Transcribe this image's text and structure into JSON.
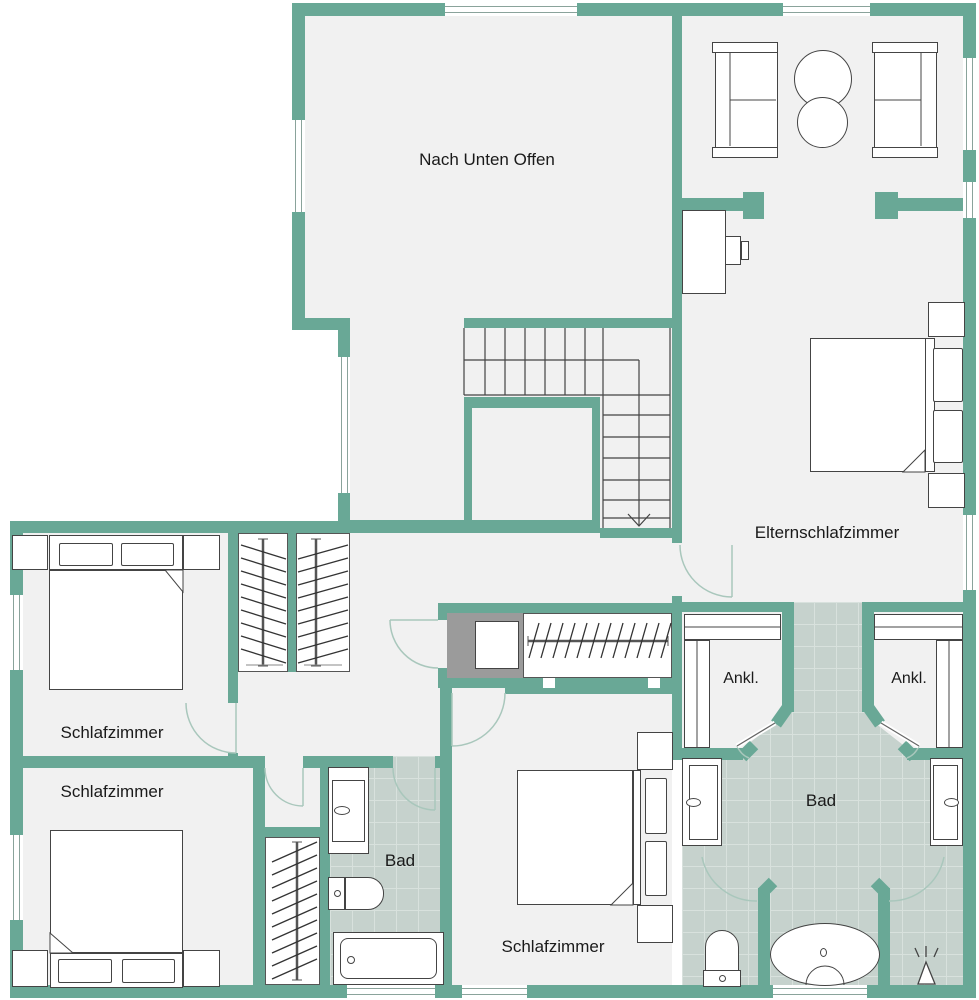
{
  "palette": {
    "wall": "#69a896",
    "floor": "#f1f1f1",
    "tile": "#c6d2cd",
    "tile_line": "#d8e1dd",
    "shaft": "#9b9b9b",
    "outline": "#444444",
    "door_arc": "#a9c7bc"
  },
  "rooms": {
    "open_space": {
      "label": "Nach Unten Offen"
    },
    "master": {
      "label": "Elternschlafzimmer"
    },
    "bedroom_left": {
      "label": "Schlafzimmer"
    },
    "bedroom_bottom_left": {
      "label": "Schlafzimmer"
    },
    "bedroom_bottom_mid": {
      "label": "Schlafzimmer"
    },
    "closet_left": {
      "label": "Ankl."
    },
    "closet_right": {
      "label": "Ankl."
    },
    "bath_small": {
      "label": "Bad"
    },
    "bath_large": {
      "label": "Bad"
    }
  }
}
